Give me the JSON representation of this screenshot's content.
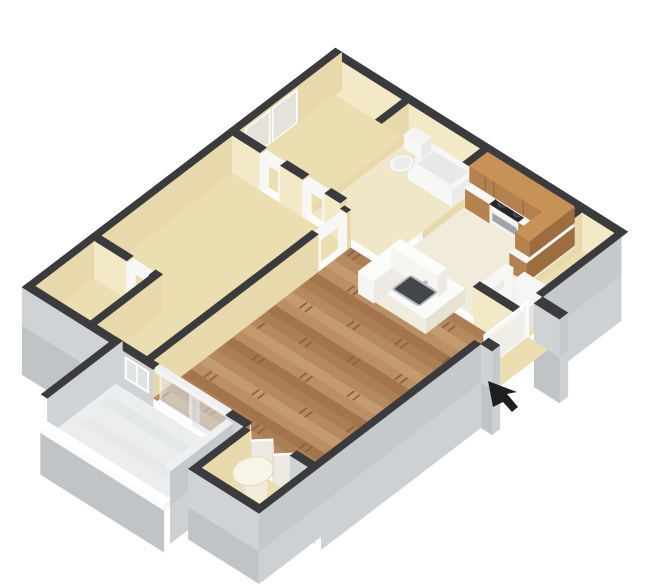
{
  "meta": {
    "type": "3d-floor-plan-rendering",
    "subject": "one-bedroom apartment, isometric dollhouse view",
    "background": "#ffffff"
  },
  "colors": {
    "background": "#ffffff",
    "wallCap": "#3b3b3d",
    "capLight": "#eef0f1",
    "creamBright": "#f3e9c6",
    "creamMid": "#e8d9ac",
    "creamDeep": "#dccb96",
    "grayX": "#c5c9cc",
    "grayY": "#cfd3d6",
    "slabSE": "#cdd1d4",
    "slabSW": "#c0c4c7",
    "floorCream": "#ebdfb2",
    "floorBath": "#f0e7c8",
    "floorKitchen": "#f1ebdb",
    "floorPatio": "#ebedee",
    "patioStreak": "#e2e5e7",
    "plankA": "#ba8f65",
    "plankB": "#ac7e54",
    "plankC": "#c49b6f",
    "plankD": "#a4754d",
    "plankE": "#b6895e",
    "plankJoint": "#8a6243",
    "cabinet": "#b5824f",
    "cabinetLight": "#c89158",
    "cabinetDark": "#9c6d3f",
    "white": "#f7f7f6",
    "applianceSide": "#dfdfdf",
    "cooktop": "#26272a",
    "burner": "#3a3d3f",
    "burnerRim": "#55585a",
    "steel": "#b9bcbe",
    "ovenWindow": "#a0a4a6",
    "glass": "#d9e5ea",
    "doorWhite": "#f6f5f1",
    "frameShade": "#e4e2da",
    "sinkBasin": "#44474a",
    "heater": "#f2ecd9",
    "heaterShade": "#e6dfc9",
    "heaterTop": "#f8f4e6",
    "cursor": "#1f1f21"
  },
  "scene": {
    "rooms": [
      {
        "name": "hall-closet-nook",
        "floor": "carpet"
      },
      {
        "name": "bathroom",
        "floor": "tile"
      },
      {
        "name": "kitchen",
        "floor": "tile"
      },
      {
        "name": "utility-closet",
        "floor": "tile"
      },
      {
        "name": "bedroom",
        "floor": "carpet"
      },
      {
        "name": "bedroom-closet",
        "floor": "carpet"
      },
      {
        "name": "living-dining-room",
        "floor": "hardwood"
      },
      {
        "name": "patio",
        "floor": "concrete"
      },
      {
        "name": "storage-closet",
        "floor": "carpet"
      },
      {
        "name": "entry-alcove",
        "floor": "carpet"
      }
    ],
    "fixtures": [
      "bathtub",
      "toilet",
      "mirrored-closet-doors",
      "upper-cabinets",
      "microwave",
      "range-oven",
      "base-cabinets",
      "utility-unit",
      "breakfast-bar-island",
      "island-sink",
      "water-heater",
      "sliding-glass-door",
      "bifold-closet-doors",
      "front-door",
      "bedroom-window"
    ],
    "cursor": {
      "icon": "arrow-pointer",
      "color": "#1f1f21"
    }
  }
}
